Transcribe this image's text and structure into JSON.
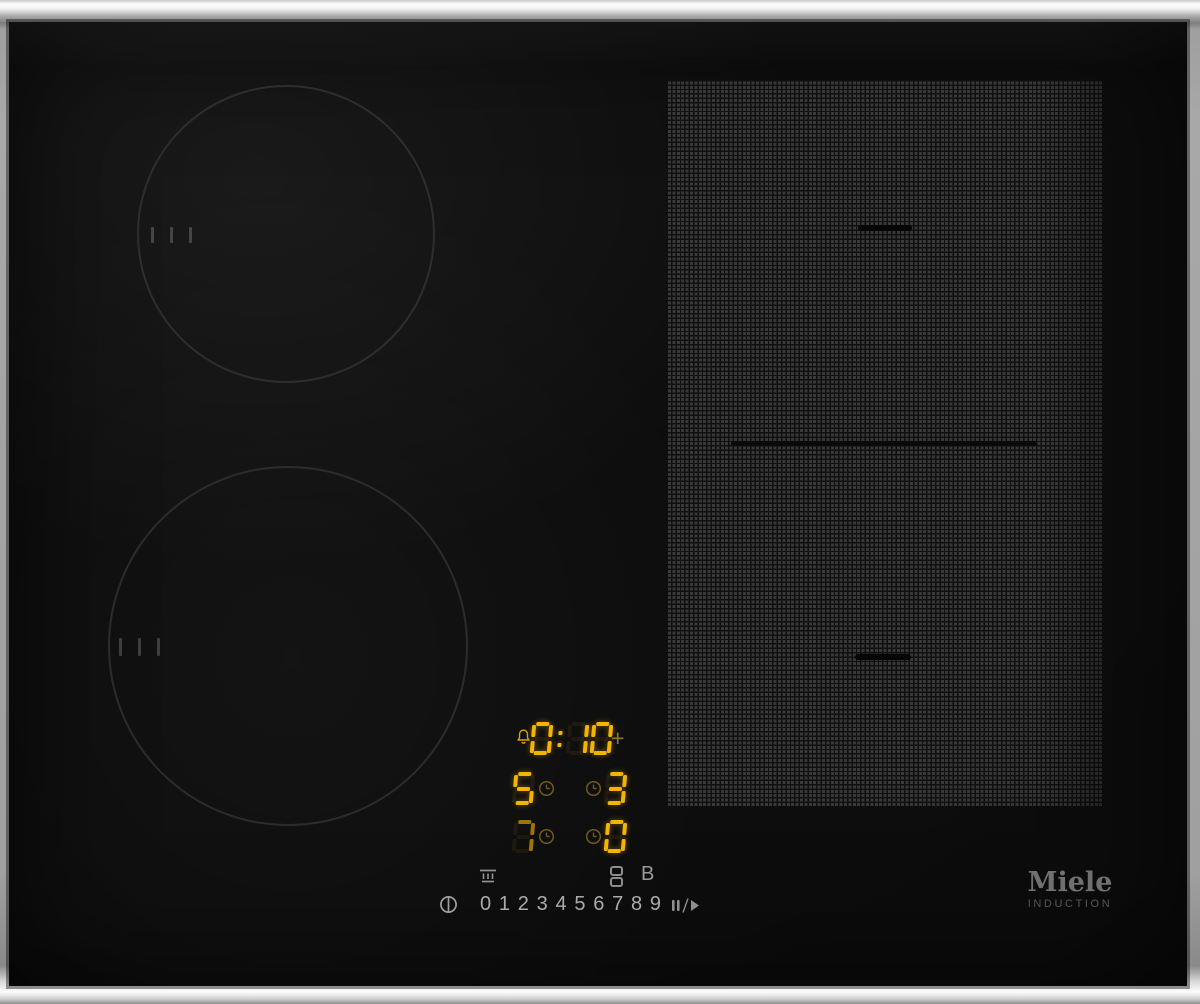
{
  "brand": {
    "logo": "Miele",
    "sublabel": "INDUCTION"
  },
  "display": {
    "timer": {
      "value": "0:10",
      "plus_label": "+"
    },
    "zone_rows": [
      {
        "left": "5",
        "left_dim": false,
        "right": "3",
        "right_dim": false
      },
      {
        "left": "7",
        "left_dim": true,
        "right": "0",
        "right_dim": false
      }
    ]
  },
  "controls": {
    "booster_label": "B",
    "power_digits": [
      "0",
      "1",
      "2",
      "3",
      "4",
      "5",
      "6",
      "7",
      "8",
      "9"
    ]
  },
  "icons": {
    "bell": "timer-bell-icon",
    "clock": "zone-timer-clock-icon",
    "keep_warm": "keep-warm-icon",
    "bridge": "bridge-zones-icon",
    "power": "power-standby-icon",
    "stop_go": "stop-and-go-icon"
  },
  "colors": {
    "segment_lit": "#f6b300",
    "segment_dim": "#9d7405",
    "indicator_amber": "#d9a400",
    "clock_amber": "#70591d",
    "icon_grey": "#959595",
    "digit_grey": "#ababab",
    "logo_grey": "#707070",
    "frame_silver": "#d9d9d9",
    "glass_black": "#0d0d0d"
  }
}
